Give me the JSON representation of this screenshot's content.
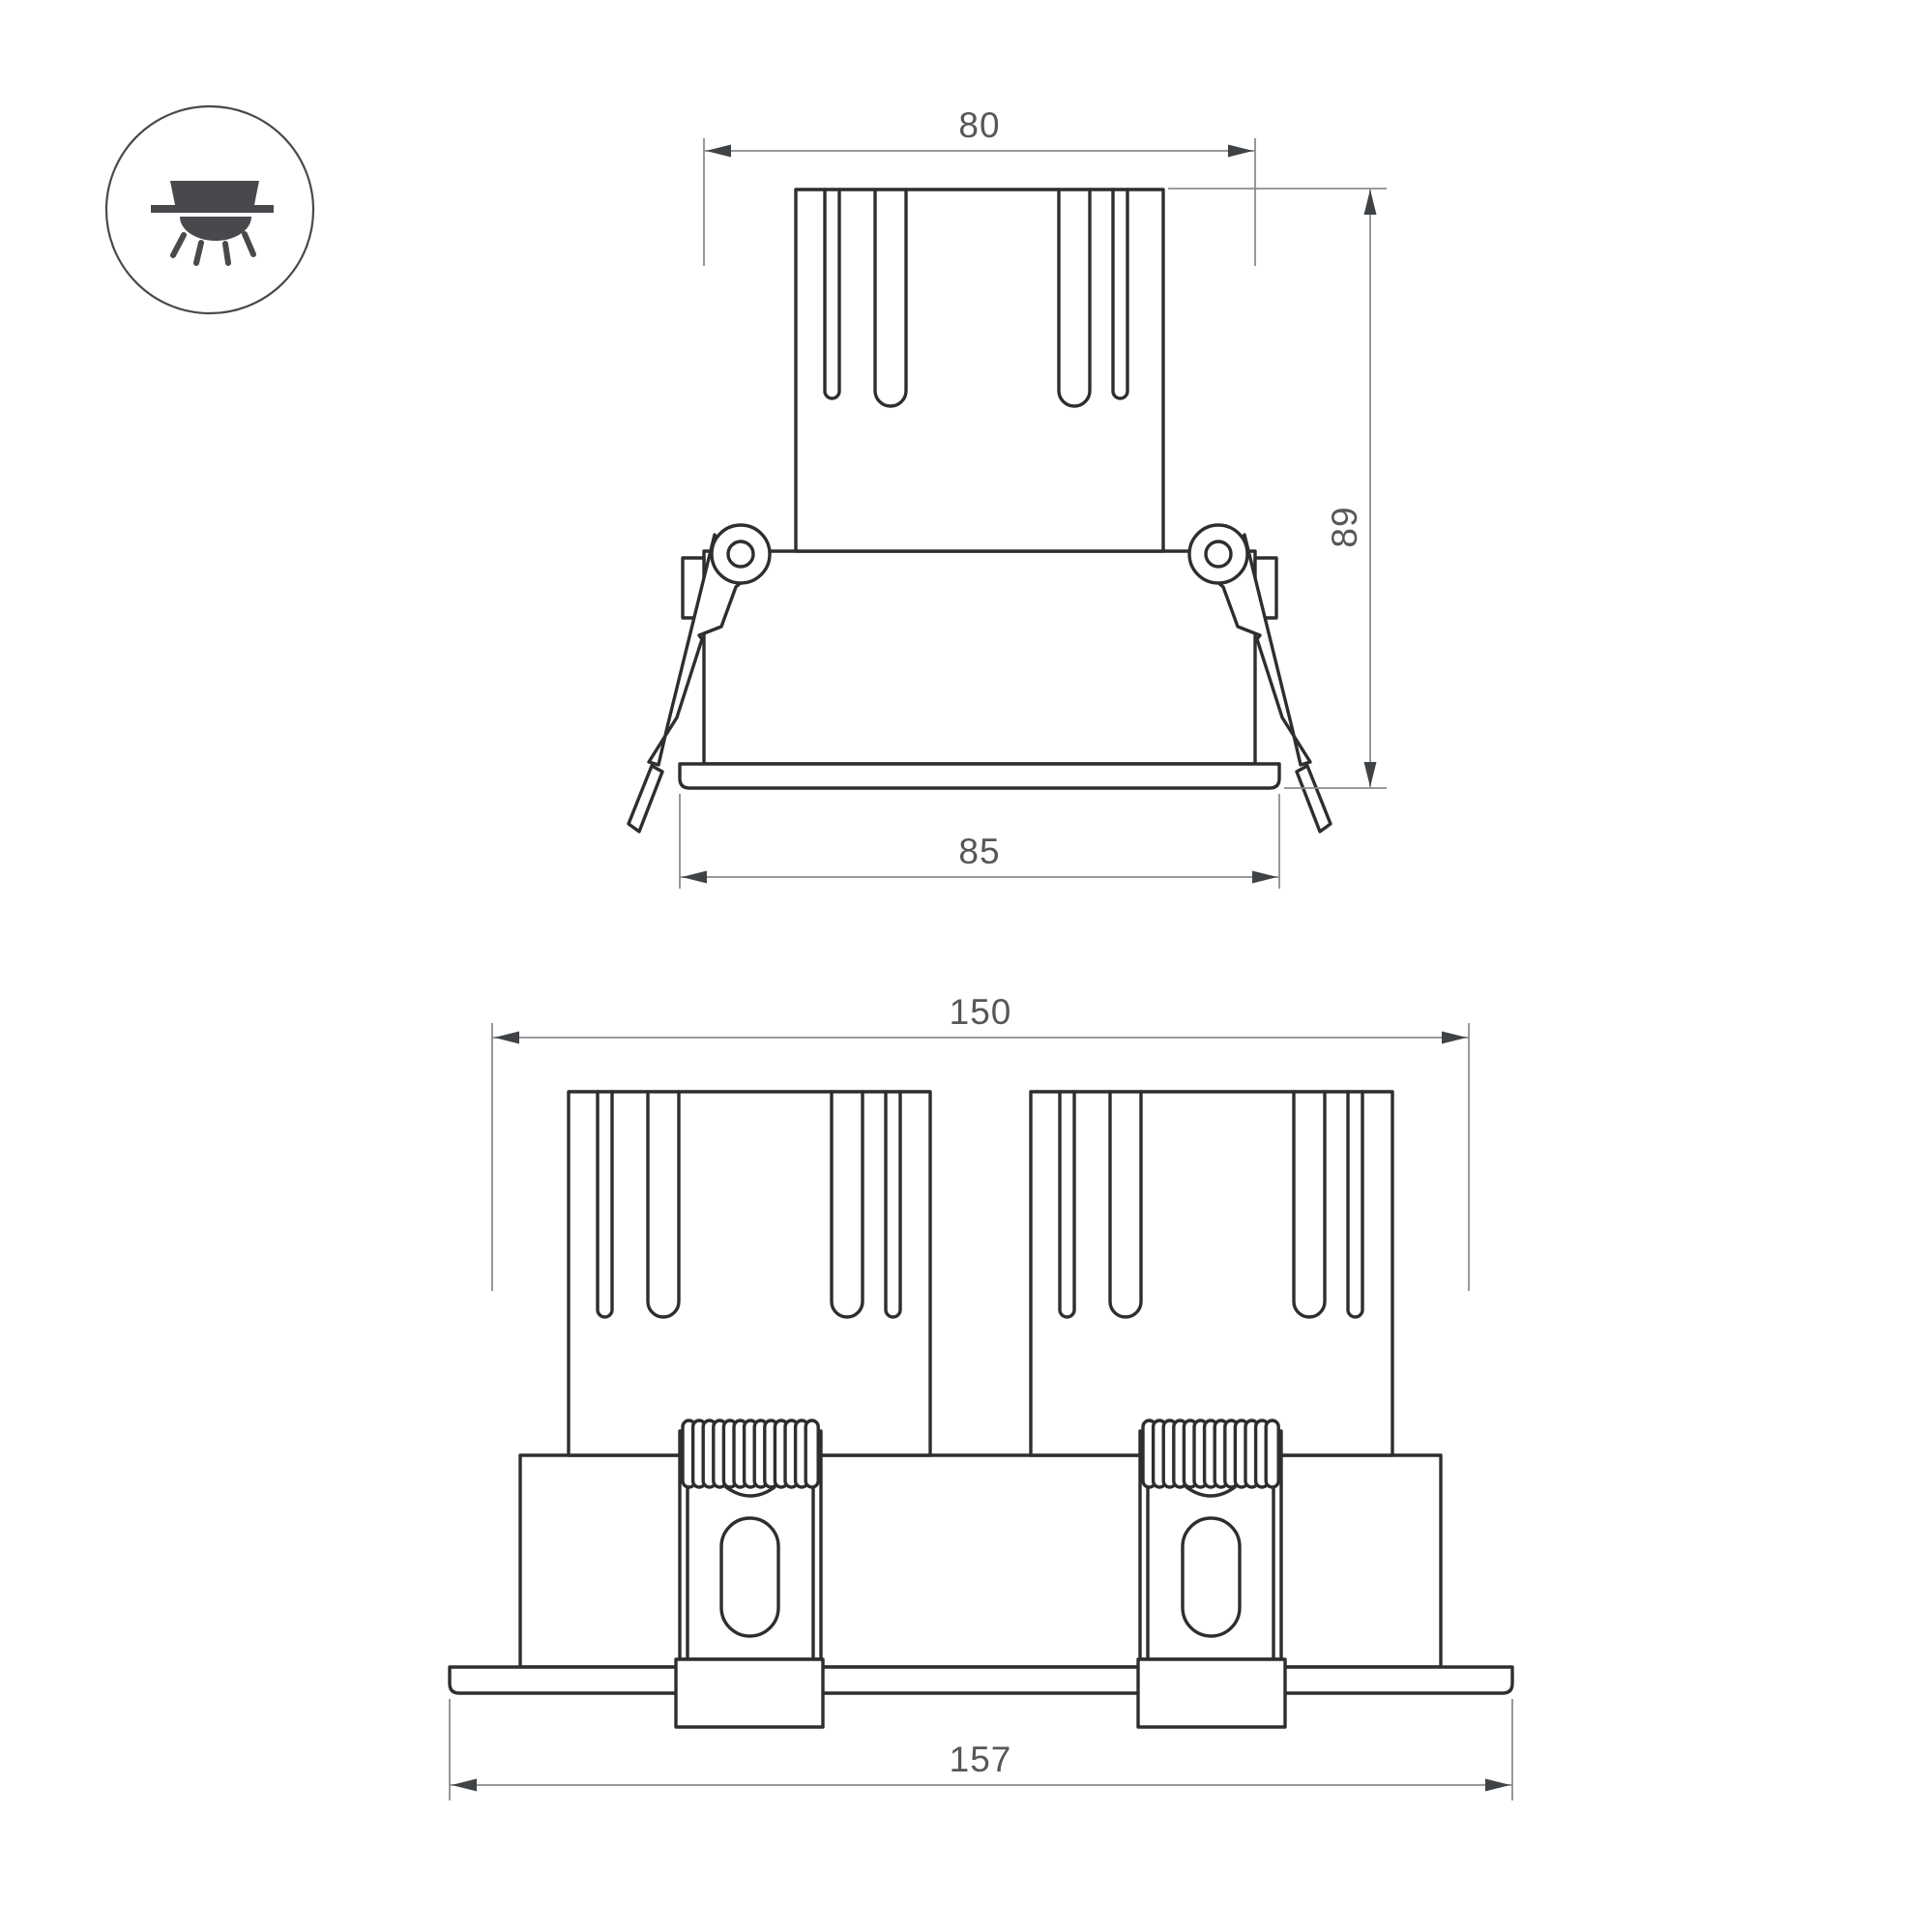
{
  "page": {
    "background": "#ffffff",
    "description": "Technical dimension drawing of recessed downlight luminaires (single and twin versions)"
  },
  "icon": {
    "label": "recessed-downlight"
  },
  "single_view": {
    "width_mm": "80",
    "height_mm": "89",
    "flange_mm": "85"
  },
  "double_view": {
    "width_mm": "150",
    "flange_mm": "157"
  },
  "colors": {
    "outline": "#2c2e30",
    "dim_line": "#8a8c8e",
    "dim_text": "#55575a",
    "arrow": "#404346",
    "icon": "#47494d"
  }
}
